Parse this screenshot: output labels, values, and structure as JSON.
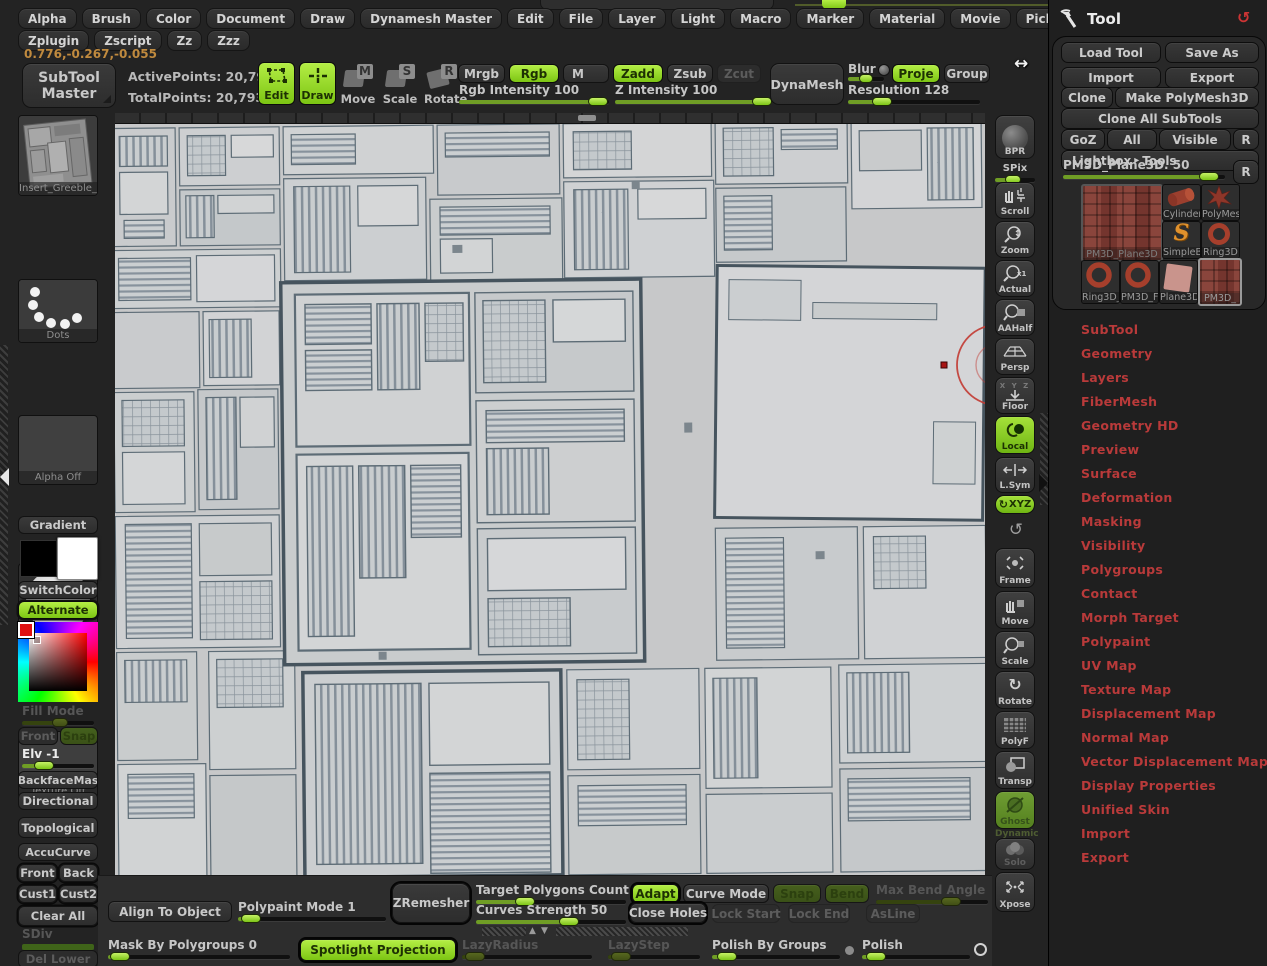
{
  "colors": {
    "accent_green": "#99e028",
    "menu_red": "#b93a3a",
    "coords_orange": "#c08a3e",
    "canvas_gray": "#c7c8c9"
  },
  "icons": {
    "reset": "↺",
    "rotate": "↻",
    "lightbox_arrow": "▸",
    "collapse_up": "▲",
    "collapse_down": "▼",
    "cursor_resize_h": "↔",
    "radio_dot": "●",
    "radio_ring": "○"
  },
  "menubar": {
    "items": [
      "Alpha",
      "Brush",
      "Color",
      "Document",
      "Draw",
      "Dynamesh Master",
      "Edit",
      "File",
      "Layer",
      "Light",
      "Macro",
      "Marker",
      "Material",
      "Movie",
      "Picker",
      "Preferences",
      "Render",
      "Stencil",
      "Stroke",
      "Texture",
      "Tool",
      "Transform"
    ]
  },
  "menubar2": {
    "items": [
      "Zplugin",
      "Zscript",
      "Zz",
      "Zzz"
    ]
  },
  "coords": "0.776,-0.267,-0.055",
  "top_shelf": {
    "subtool_master_line1": "SubTool",
    "subtool_master_line2": "Master",
    "active_points": "ActivePoints: 20,793",
    "total_points": "TotalPoints: 20,793",
    "edit": "Edit",
    "draw": "Draw",
    "move": "Move",
    "scale": "Scale",
    "rotate": "Rotate",
    "move_letter": "M",
    "scale_letter": "S",
    "rotate_letter": "R",
    "mrgb": "Mrgb",
    "rgb": "Rgb",
    "m": "M",
    "rgb_intensity": "Rgb Intensity 100",
    "zadd": "Zadd",
    "zsub": "Zsub",
    "zcut": "Zcut",
    "z_intensity": "Z Intensity 100",
    "dynamesh": "DynaMesh",
    "blur": "Blur",
    "proje": "Proje",
    "group": "Group",
    "resolution": "Resolution 128"
  },
  "left_tray": {
    "brush_label": "Insert_Greeble_",
    "stroke_label": "Dots",
    "alpha_label": "Alpha  Off",
    "material_label": "BasicMaterial",
    "texture_label": "Texture  Off",
    "gradient": "Gradient",
    "switch_color": "SwitchColor",
    "alternate": "Alternate",
    "fill_mode": "Fill Mode",
    "front": "Front",
    "snap": "Snap",
    "elv": "Elv -1",
    "backface_mask": "BackfaceMas",
    "directional": "Directional",
    "topological": "Topological",
    "accucurve": "AccuCurve",
    "front2": "Front",
    "back": "Back",
    "cust1": "Cust1",
    "cust2": "Cust2",
    "clear_all": "Clear All",
    "sdiv": "SDiv",
    "del_lower": "Del Lower",
    "del_higher": "Del Higher"
  },
  "right_shelf": {
    "bpr": "BPR",
    "spix": "SPix",
    "scroll": "Scroll",
    "zoom": "Zoom",
    "actual": "Actual",
    "aahalf": "AAHalf",
    "persp": "Persp",
    "floor": "Floor",
    "floor_axes": "X Y Z",
    "local": "Local",
    "lsym": "L.Sym",
    "gxyz": "XYZ",
    "frame": "Frame",
    "move": "Move",
    "scale": "Scale",
    "rotate": "Rotate",
    "polyf": "PolyF",
    "transp": "Transp",
    "ghost": "Ghost",
    "dynamic": "Dynamic",
    "solo": "Solo",
    "xpose": "Xpose"
  },
  "tool_panel": {
    "title": "Tool",
    "load_tool": "Load Tool",
    "save_as": "Save As",
    "import": "Import",
    "export": "Export",
    "clone": "Clone",
    "make_polymesh3d": "Make PolyMesh3D",
    "clone_all_subtools": "Clone All SubTools",
    "goz": "GoZ",
    "all": "All",
    "visible": "Visible",
    "r": "R",
    "lightbox": "Lightbox",
    "tools": "Tools",
    "item_slider": "PM3D_Plane3D. 50",
    "r2": "R",
    "thumbs": {
      "big_label": "PM3D_Plane3D",
      "cylinder_label": "Cylinder:",
      "polymes_label": "PolyMes",
      "simplebr_label": "SimpleBr",
      "ring3d_label": "Ring3D",
      "ring3d2_label": "Ring3D_",
      "pm3df_label": "PM3D_F",
      "plane3d_label": "Plane3D",
      "pm3d_label": "PM3D_"
    },
    "sections": [
      "SubTool",
      "Geometry",
      "Layers",
      "FiberMesh",
      "Geometry HD",
      "Preview",
      "Surface",
      "Deformation",
      "Masking",
      "Visibility",
      "Polygroups",
      "Contact",
      "Morph Target",
      "Polypaint",
      "UV Map",
      "Texture Map",
      "Displacement Map",
      "Normal Map",
      "Vector Displacement Map",
      "Display Properties",
      "Unified Skin",
      "Import",
      "Export"
    ]
  },
  "bottom_shelf": {
    "align_to_object": "Align To Object",
    "polypaint_mode": "Polypaint Mode 1",
    "zremesher": "ZRemesher",
    "target_polygons": "Target Polygons Count 5",
    "curves_strength": "Curves Strength 50",
    "adapt": "Adapt",
    "curve_mode": "Curve Mode",
    "snap": "Snap",
    "bend": "Bend",
    "max_bend_angle": "Max Bend Angle",
    "close_holes": "Close Holes",
    "lock_start": "Lock Start",
    "lock_end": "Lock End",
    "asline": "AsLine",
    "mask_by_polygroups": "Mask By Polygroups 0",
    "spotlight_projection": "Spotlight Projection",
    "lazy_radius": "LazyRadius",
    "lazy_step": "LazyStep",
    "polish_by_groups": "Polish By Groups",
    "polish": "Polish"
  }
}
